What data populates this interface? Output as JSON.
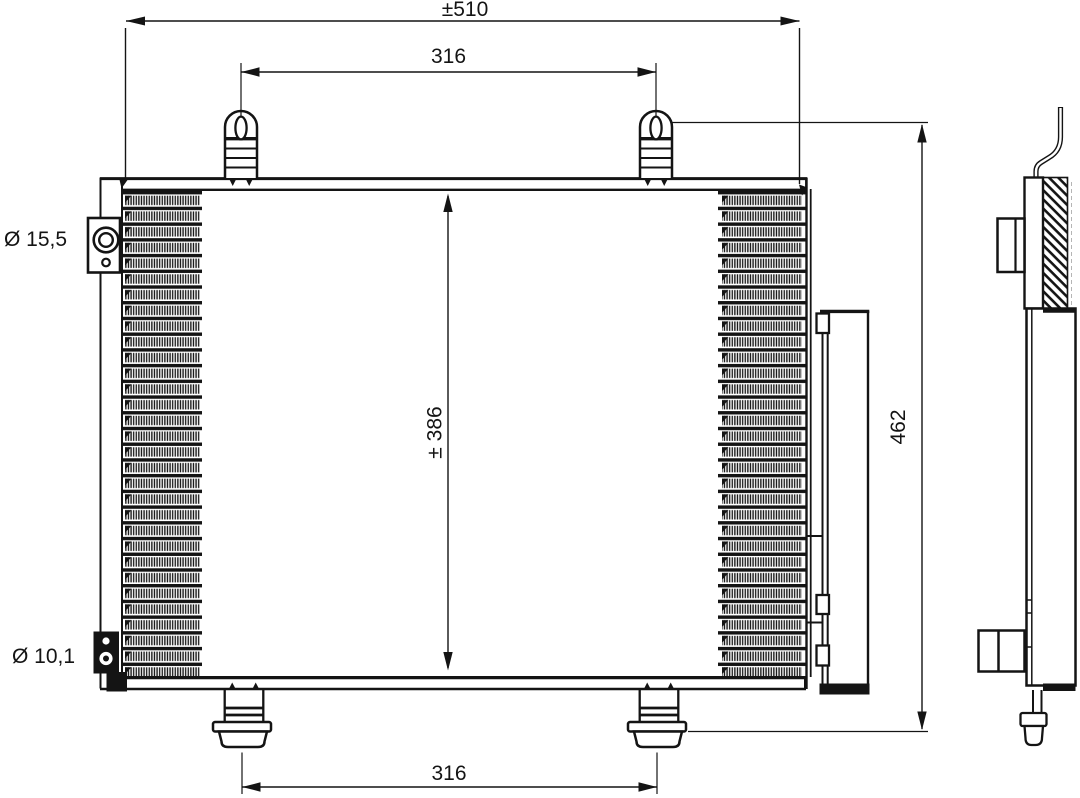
{
  "drawing": {
    "type": "technical-dimension-drawing",
    "subject": "air-conditioning condenser with receiver drier, front and side view",
    "line_color": "#141414",
    "background_color": "#ffffff",
    "dimensions": {
      "overall_width_label": "±510",
      "top_pin_spacing_label": "316",
      "core_height_label": "± 386",
      "overall_height_label": "462",
      "bottom_foot_spacing_label": "316",
      "top_port_diameter_label": "Ø 15,5",
      "bottom_port_diameter_label": "Ø 10,1"
    }
  }
}
